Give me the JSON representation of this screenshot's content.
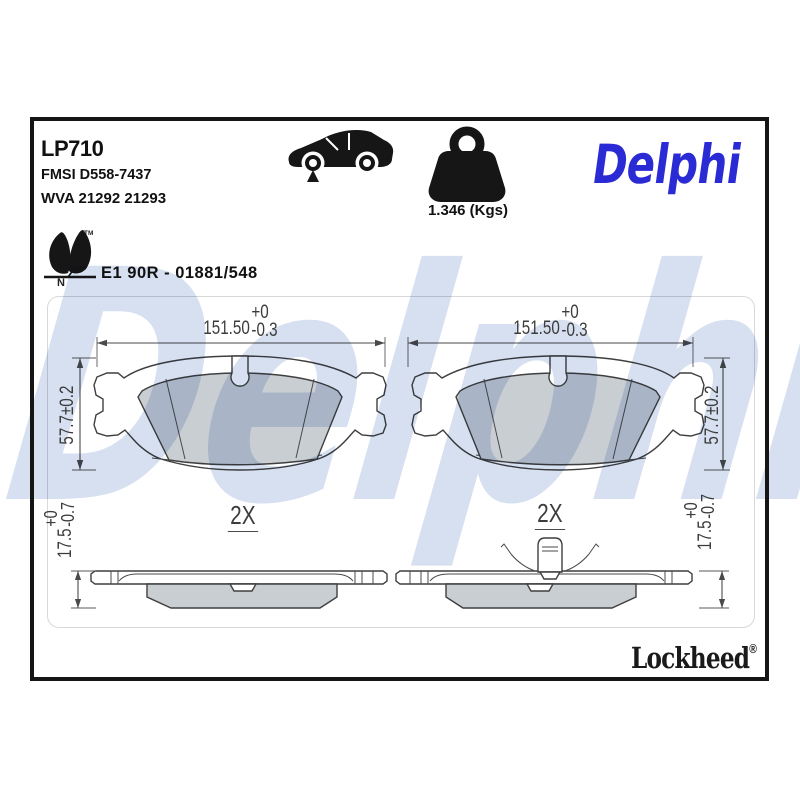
{
  "sheet": {
    "part_number": "LP710",
    "fmsi_code": "FMSI D558-7437",
    "wva_code": "WVA 21292 21293",
    "weight": "1.346 (Kgs)",
    "approval_code": "E1 90R - 01881/548",
    "brand_logo": "Delphi",
    "watermark": "Delphi",
    "footer_brand": "Lockheed",
    "registered_symbol": "®",
    "leaf_trademark": "TM",
    "leaf_letter": "N"
  },
  "dimensions": {
    "pad_width": "151.50",
    "pad_width_tol_upper": "+0",
    "pad_width_tol_lower": "-0.3",
    "pad_height": "57.7±0.2",
    "pad_thickness": "17.5",
    "pad_thickness_tol_upper": "+0",
    "pad_thickness_tol_lower": "-0.7",
    "per_axle_qty": "2X"
  },
  "colors": {
    "brand_blue": "#2b2bd5",
    "watermark_blue": "#d6e0f0",
    "friction_gray": "#c9ced3"
  }
}
